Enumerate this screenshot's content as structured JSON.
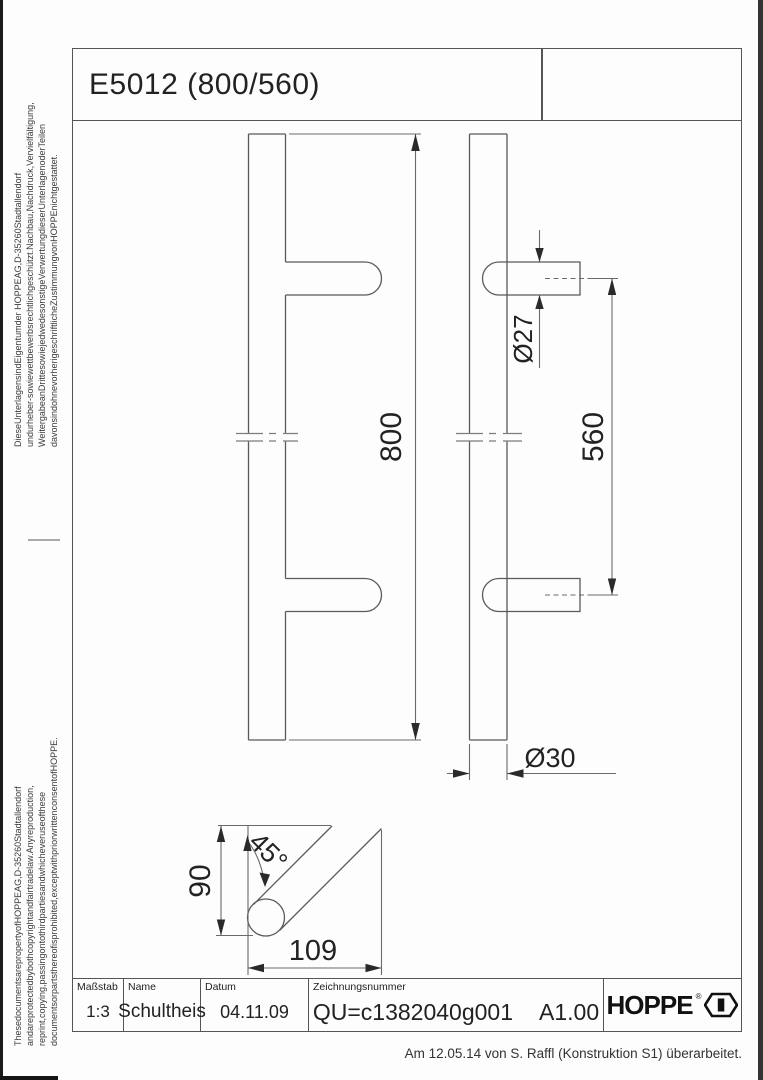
{
  "sheet": {
    "title": "E5012 (800/560)",
    "revision_note": "Am 12.05.14 von S. Raffl (Konstruktion S1) überarbeitet."
  },
  "legal": {
    "german": [
      "DieseUnterlagensindEigentumder HOPPEAG,D-35260Stadtallendorf",
      "undurheber-sowiewettbewerbsrechtlichgeschützt.Nachbau,Nachdruck,Vervielfältigung,",
      "WeitergabeanDrittesowiejedwedesonstigeVerwertungdieserUnterlagenoderTeilen",
      "davonsindohnevorherigeschriftlicheZustimmungvonHOPPEnichtgestattet."
    ],
    "english": [
      "ThesedocumentsarepropertyofHOPPEAG,D-35260Stadtallendorf",
      "andareprotectedbybothcopyrightandfairtradelaw.Anyreproduction,",
      "reprint,copying,passingontothirdpartiesandwhicheveruseofthese",
      "documentsorpartsthereofisprohibited,exceptwithpriorwrittenconsentofHOPPE."
    ]
  },
  "title_block": {
    "scale_label": "Maßstab",
    "scale_value": "1:3",
    "name_label": "Name",
    "name_value": "Schultheis",
    "date_label": "Datum",
    "date_value": "04.11.09",
    "number_label": "Zeichnungsnummer",
    "number_value": "QU=c1382040g001",
    "revision_value": "A1.00",
    "brand": "HOPPE",
    "registered_mark": "®"
  },
  "dimensions": {
    "overall_length": "800",
    "hole_distance": "560",
    "support_diameter": "Ø27",
    "tube_diameter": "Ø30",
    "projection": "90",
    "support_length": "109",
    "support_angle": "45°"
  },
  "colors": {
    "line": "#5a5a5a",
    "dim_text": "#222222",
    "frame": "#555555",
    "edge_bar": "#1c1c1c"
  }
}
